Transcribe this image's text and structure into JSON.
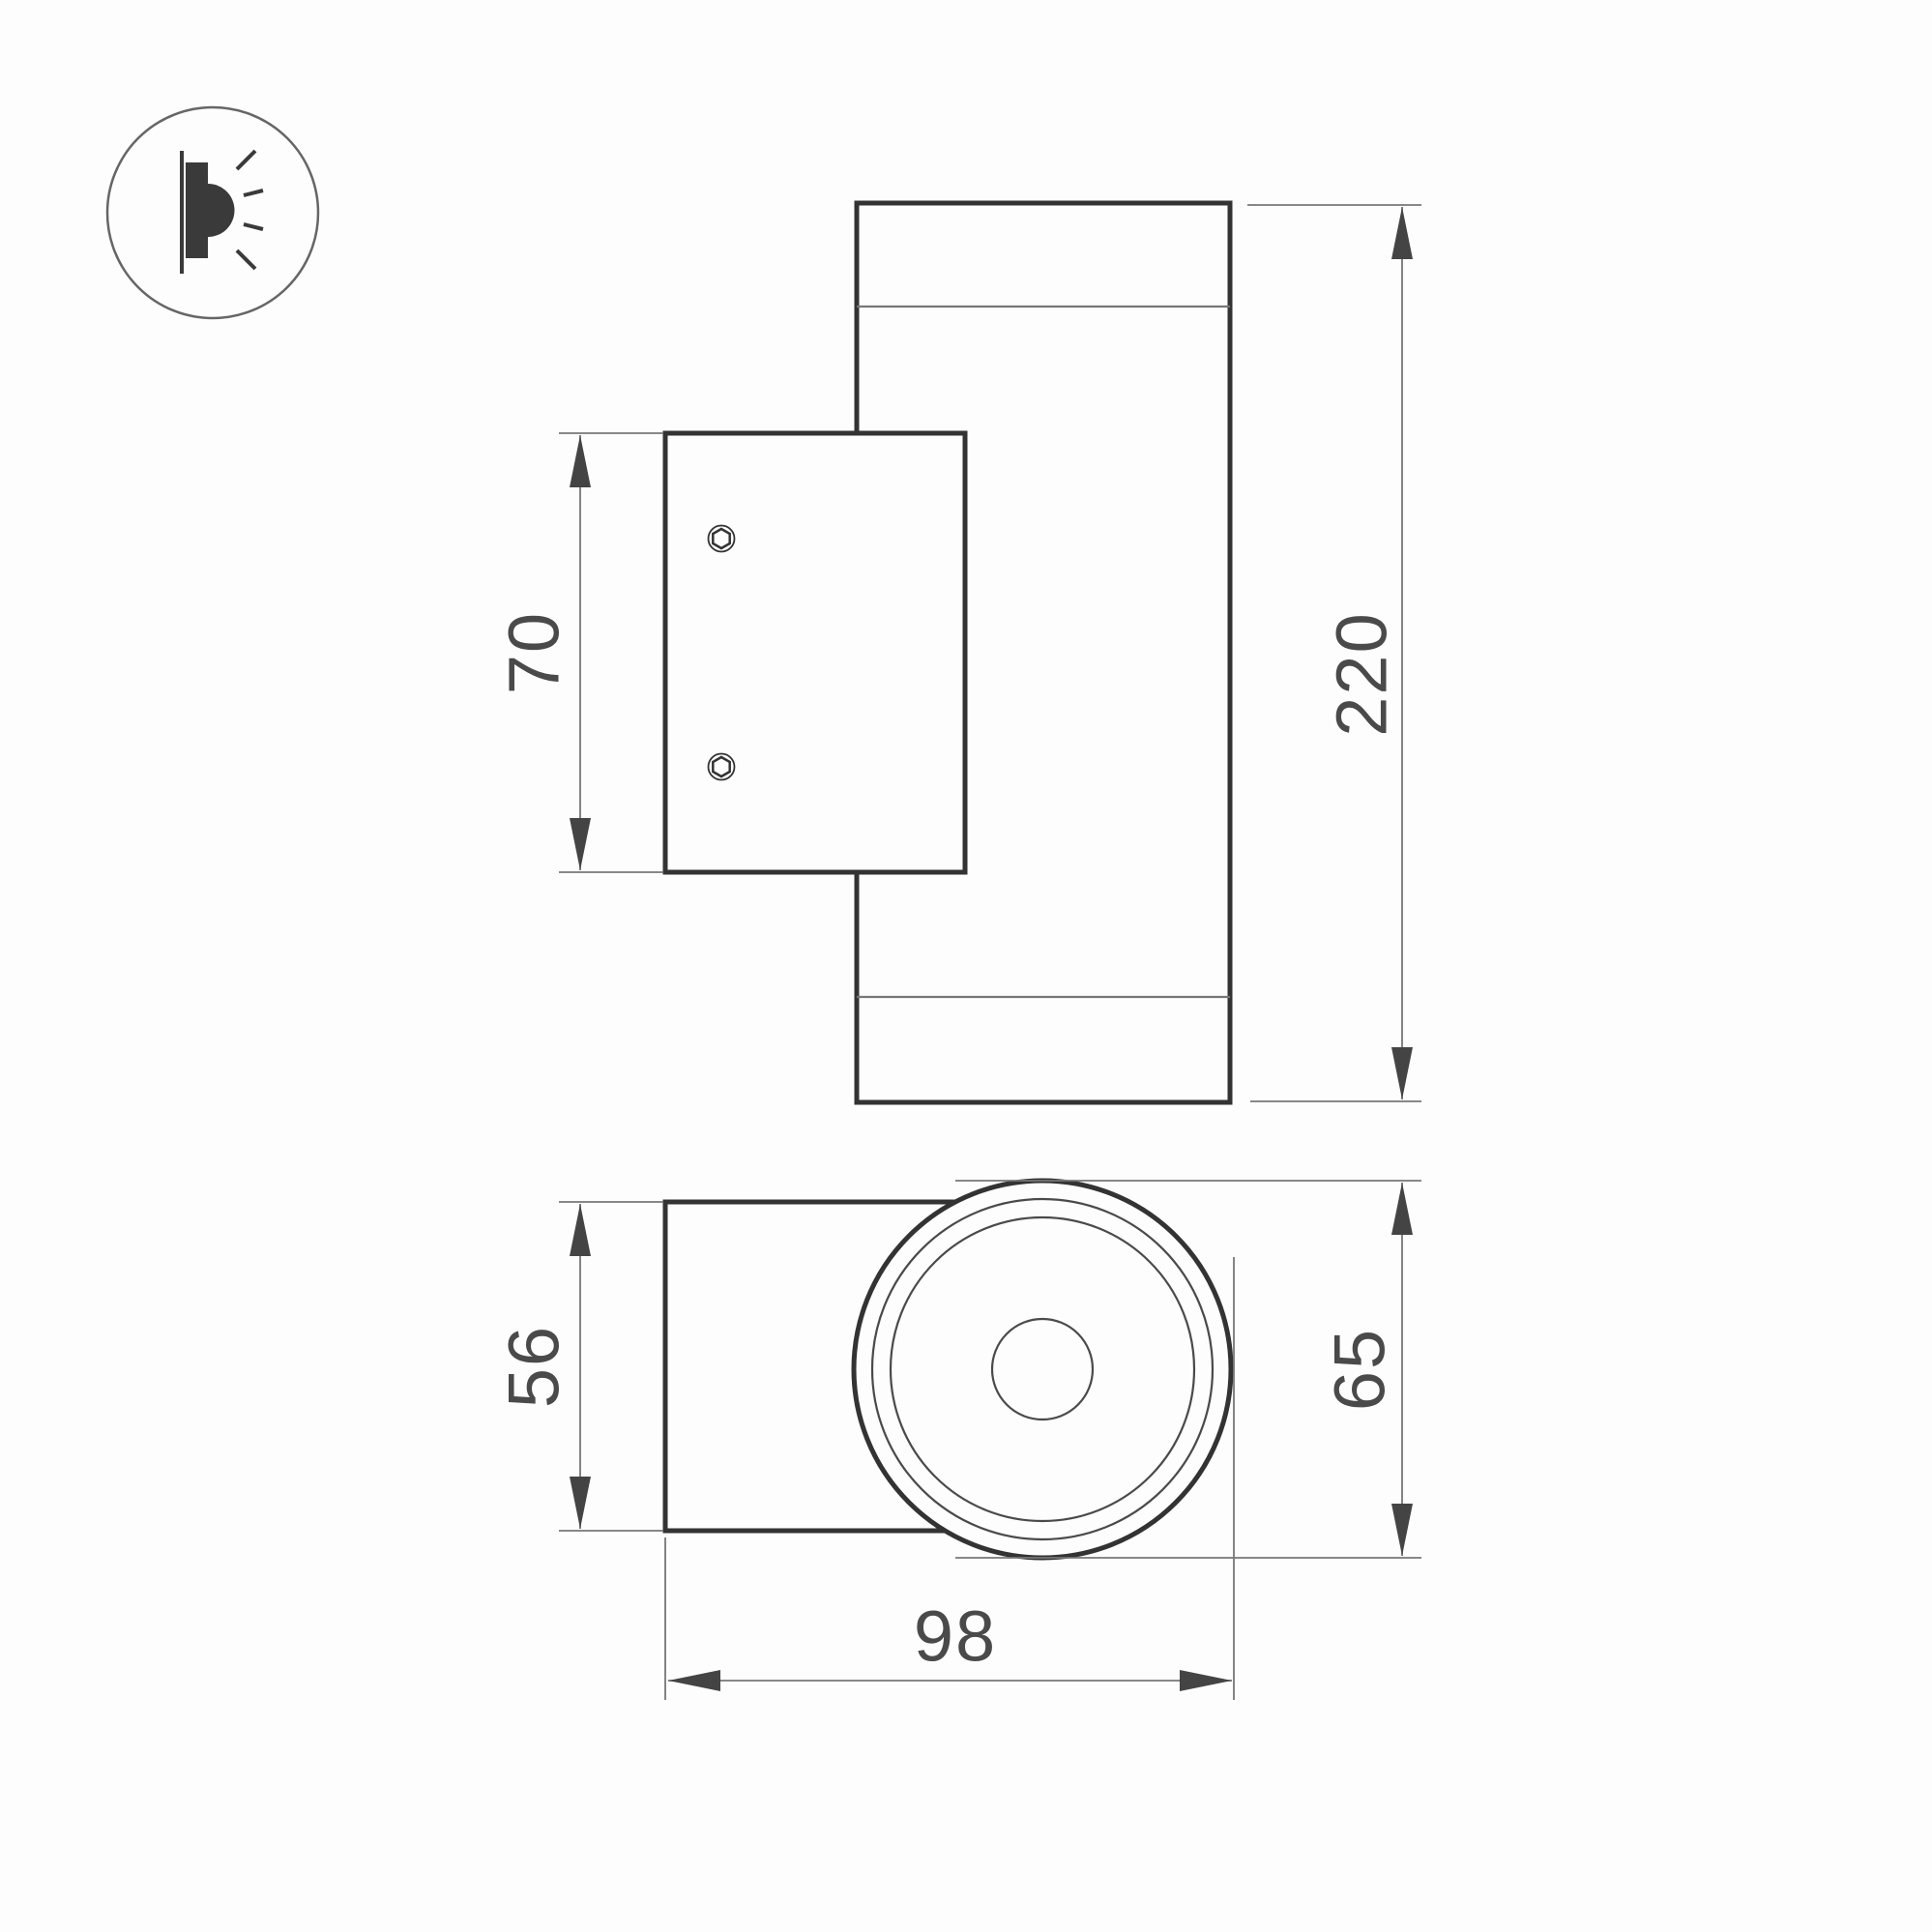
{
  "icon": {
    "name": "wall-light-emission-icon"
  },
  "dimensions": {
    "plate_height": "70",
    "body_height": "220",
    "bracket_height": "56",
    "body_diameter": "65",
    "total_depth": "98"
  },
  "colors": {
    "outline": "#333333",
    "thin_line": "#777777",
    "dimension_line": "#777777",
    "arrow": "#444444",
    "text": "#4a4a4a",
    "background": "#fdfdfd"
  }
}
